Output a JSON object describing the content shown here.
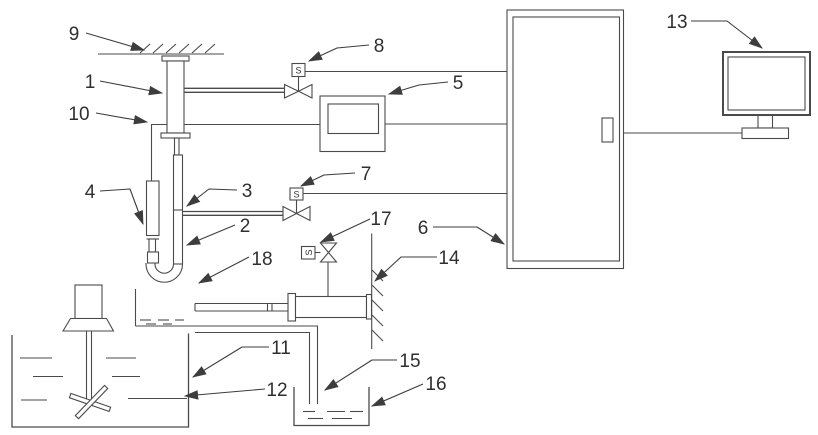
{
  "diagram": {
    "type": "patent-style schematic of liquid sampling / metering apparatus",
    "colors": {
      "background": "#ffffff",
      "line": "#4a4a4a",
      "label": "#2f2f2f"
    },
    "part_labels": {
      "n1": "1",
      "n2": "2",
      "n3": "3",
      "n4": "4",
      "n5": "5",
      "n6": "6",
      "n7": "7",
      "n8": "8",
      "n9": "9",
      "n10": "10",
      "n11": "11",
      "n12": "12",
      "n13": "13",
      "n14": "14",
      "n15": "15",
      "n16": "16",
      "n17": "17",
      "n18": "18"
    },
    "solenoid_letter": "S"
  }
}
